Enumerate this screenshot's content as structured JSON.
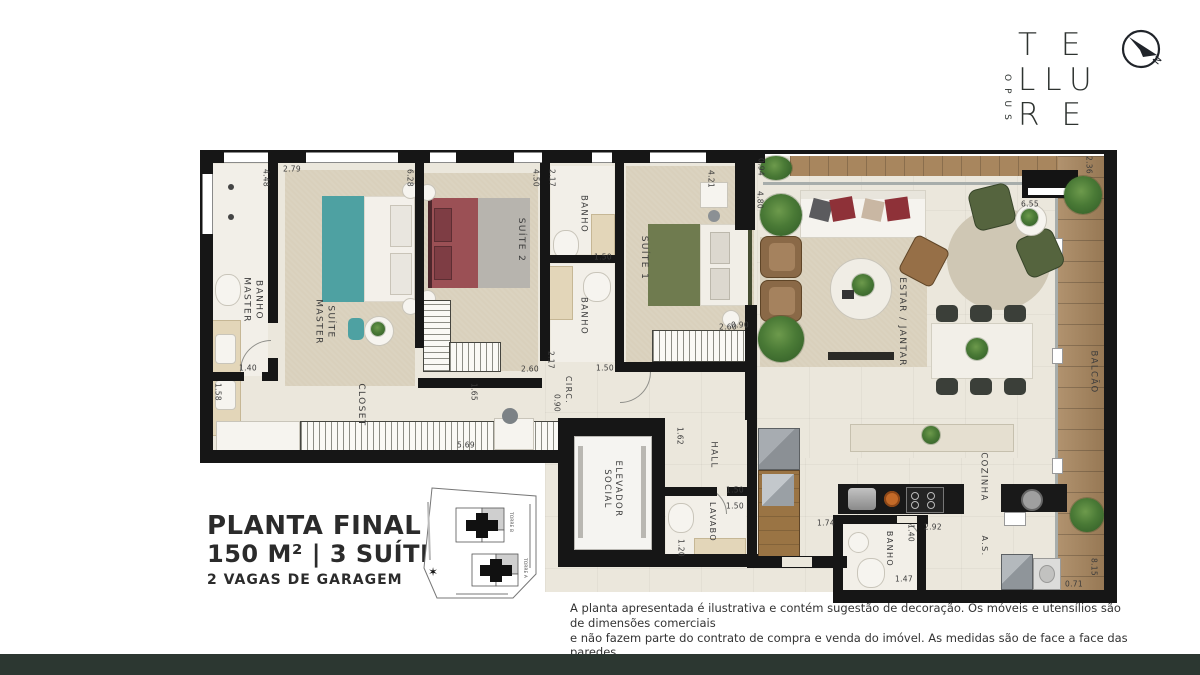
{
  "page": {
    "background": "#ffffff",
    "footer_color": "#2c3731"
  },
  "brand": {
    "vertical": "OPUS",
    "line1": "TE",
    "line2": "LLU",
    "line3": "RE"
  },
  "compass": {
    "label": "N"
  },
  "title_block": {
    "title": "PLANTA FINAL 1",
    "subtitle": "150 M²  |  3 SUÍTES",
    "garage": "2 VAGAS  DE GARAGEM"
  },
  "disclaimer": {
    "line1": "A planta apresentada é ilustrativa e contém sugestão de decoração. Os móveis e utensílios são de dimensões comerciais",
    "line2": "e não fazem parte do contrato de compra e venda do imóvel. As medidas são de face a face das paredes.",
    "line3": "*A porta de correr entre sala e cozinha será oferecida como opcional."
  },
  "key_map": {
    "towers": [
      {
        "label": "TORRE B"
      },
      {
        "label": "TORRE A"
      }
    ]
  },
  "palette": {
    "wall": "#161616",
    "floor": "#ebe7dc",
    "carpet": "#d9d0bc",
    "wood": "#a8865e",
    "bed_master": "#4ea1a2",
    "bed_suite2": "#9b5055",
    "bed_suite1": "#6f7b4f",
    "armchair_green": "#55643e",
    "armchair_brown": "#8a6947"
  },
  "floor_plan": {
    "room_labels": [
      {
        "text": "BANHO\nMASTER",
        "x": 252,
        "y": 300,
        "rot": 90,
        "size": 9
      },
      {
        "text": "SUÍTE\nMASTER",
        "x": 324,
        "y": 322,
        "rot": 90,
        "size": 9
      },
      {
        "text": "SUÍTE 2",
        "x": 520,
        "y": 240,
        "rot": 90,
        "size": 9
      },
      {
        "text": "BANHO",
        "x": 583,
        "y": 214,
        "rot": 90,
        "size": 8.5
      },
      {
        "text": "BANHO",
        "x": 583,
        "y": 316,
        "rot": 90,
        "size": 8.5
      },
      {
        "text": "SUÍTE 1",
        "x": 643,
        "y": 258,
        "rot": 90,
        "size": 9
      },
      {
        "text": "CLOSET",
        "x": 360,
        "y": 405,
        "rot": 90,
        "size": 9
      },
      {
        "text": "CIRC.",
        "x": 568,
        "y": 390,
        "rot": 90,
        "size": 8
      },
      {
        "text": "ELEVADOR\nSOCIAL",
        "x": 612,
        "y": 489,
        "rot": 90,
        "size": 8.5
      },
      {
        "text": "HALL",
        "x": 713,
        "y": 455,
        "rot": 90,
        "size": 8.5
      },
      {
        "text": "LAVABO",
        "x": 712,
        "y": 522,
        "rot": 90,
        "size": 8
      },
      {
        "text": "ESTAR / JANTAR",
        "x": 901,
        "y": 322,
        "rot": 90,
        "size": 9
      },
      {
        "text": "COZINHA",
        "x": 983,
        "y": 477,
        "rot": 90,
        "size": 8.5
      },
      {
        "text": "A.S.",
        "x": 984,
        "y": 546,
        "rot": 90,
        "size": 8
      },
      {
        "text": "BANHO",
        "x": 889,
        "y": 549,
        "rot": 90,
        "size": 8
      },
      {
        "text": "BALCÃO",
        "x": 1093,
        "y": 372,
        "rot": 90,
        "size": 8.5
      }
    ],
    "dimensions": [
      {
        "text": "4.48",
        "x": 266,
        "y": 178,
        "rot": 90
      },
      {
        "text": "2.79",
        "x": 292,
        "y": 169,
        "rot": 0
      },
      {
        "text": "6.28",
        "x": 410,
        "y": 178,
        "rot": 90
      },
      {
        "text": "4.50",
        "x": 536,
        "y": 178,
        "rot": 90
      },
      {
        "text": "2.17",
        "x": 552,
        "y": 178,
        "rot": 90
      },
      {
        "text": "1.50",
        "x": 603,
        "y": 257,
        "rot": 0
      },
      {
        "text": "2.17",
        "x": 551,
        "y": 360,
        "rot": 90
      },
      {
        "text": "1.50",
        "x": 605,
        "y": 368,
        "rot": 0
      },
      {
        "text": "4.21",
        "x": 711,
        "y": 179,
        "rot": 90
      },
      {
        "text": "0.94",
        "x": 761,
        "y": 167,
        "rot": 90
      },
      {
        "text": "4.80",
        "x": 760,
        "y": 200,
        "rot": 90
      },
      {
        "text": "2.36",
        "x": 1089,
        "y": 165,
        "rot": 90
      },
      {
        "text": "6.55",
        "x": 1030,
        "y": 204,
        "rot": 0
      },
      {
        "text": "1.40",
        "x": 248,
        "y": 368,
        "rot": 0
      },
      {
        "text": "1.58",
        "x": 218,
        "y": 392,
        "rot": 90
      },
      {
        "text": "2.60",
        "x": 530,
        "y": 369,
        "rot": 0
      },
      {
        "text": "1.65",
        "x": 474,
        "y": 392,
        "rot": 90
      },
      {
        "text": "2.60",
        "x": 728,
        "y": 327,
        "rot": 0
      },
      {
        "text": "5.69",
        "x": 466,
        "y": 445,
        "rot": 0
      },
      {
        "text": "0.90",
        "x": 557,
        "y": 403,
        "rot": 90
      },
      {
        "text": "1.62",
        "x": 680,
        "y": 436,
        "rot": 90
      },
      {
        "text": "0.90",
        "x": 740,
        "y": 325,
        "rot": 0
      },
      {
        "text": "1.50",
        "x": 735,
        "y": 490,
        "rot": 0
      },
      {
        "text": "1.50",
        "x": 735,
        "y": 506,
        "rot": 0
      },
      {
        "text": "1.20",
        "x": 681,
        "y": 548,
        "rot": 90
      },
      {
        "text": "1.74",
        "x": 826,
        "y": 523,
        "rot": 0
      },
      {
        "text": "1.40",
        "x": 911,
        "y": 533,
        "rot": 90
      },
      {
        "text": "2.92",
        "x": 933,
        "y": 527,
        "rot": 0
      },
      {
        "text": "1.47",
        "x": 904,
        "y": 579,
        "rot": 0
      },
      {
        "text": "0.71",
        "x": 1074,
        "y": 584,
        "rot": 0
      },
      {
        "text": "8.15",
        "x": 1094,
        "y": 567,
        "rot": 90
      }
    ]
  }
}
